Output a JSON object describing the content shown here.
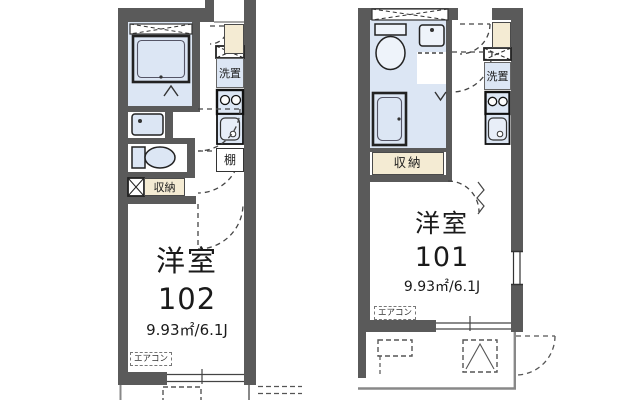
{
  "plan": {
    "type": "apartment-floor-plan",
    "units": {
      "unit102": {
        "room_type": "洋室",
        "room_number": "102",
        "area": "9.93㎡/6.1J",
        "washer_label": "洗置",
        "shelf_label": "棚",
        "storage_label": "収納",
        "aircon_label": "エアコン",
        "fixtures": [
          "bathtub",
          "washbasin",
          "toilet",
          "stove",
          "kitchen-sink",
          "washer-space",
          "shelf",
          "storage",
          "shoe-cabinet",
          "pipe-space",
          "balcony"
        ]
      },
      "unit101": {
        "room_type": "洋室",
        "room_number": "101",
        "area": "9.93㎡/6.1J",
        "washer_label": "洗置",
        "storage_label": "収納",
        "aircon_label": "エアコン",
        "fixtures": [
          "toilet",
          "washbasin",
          "bathtub",
          "stove",
          "kitchen-sink",
          "washer-space",
          "storage",
          "shoe-cabinet",
          "terrace",
          "gate"
        ]
      }
    },
    "colors": {
      "wall": "#5a5a5a",
      "fixture_fill": "#dce6f4",
      "storage_fill": "#f4ebd3",
      "line": "#333333",
      "dash_line": "#555555",
      "background": "#ffffff"
    }
  }
}
